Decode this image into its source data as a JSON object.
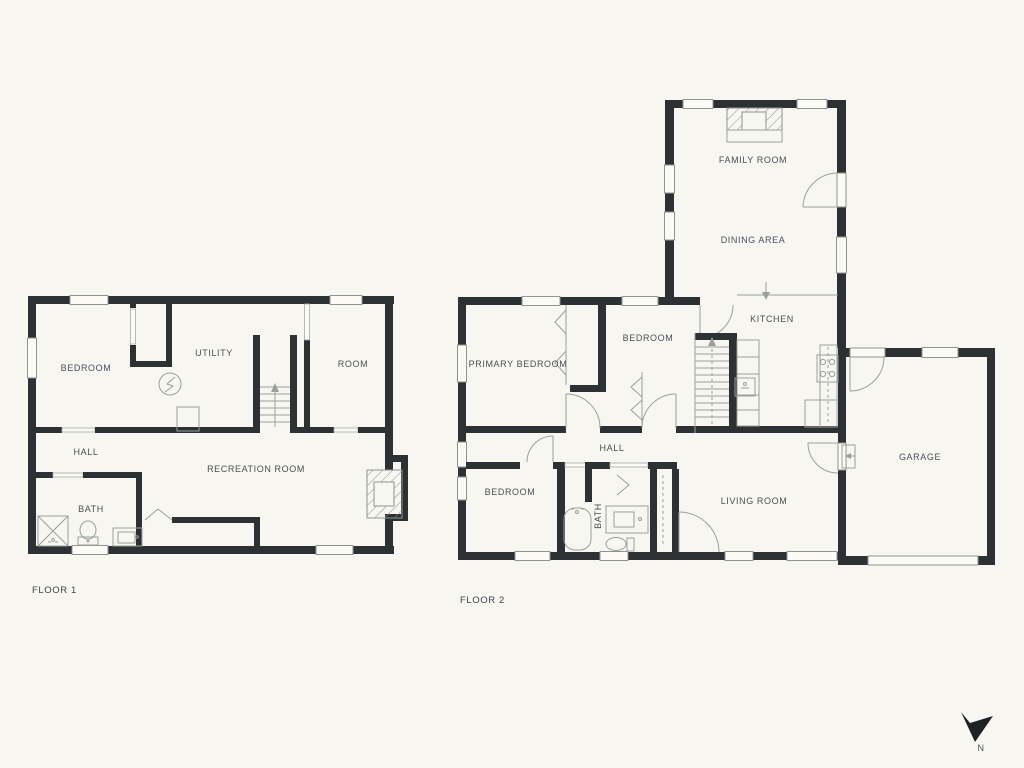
{
  "page": {
    "background_color": "#f7f6f1",
    "wall_color": "#2d3133",
    "thin_line_color": "#9aa09c",
    "text_color": "#4b5055"
  },
  "floor1": {
    "title": "FLOOR 1",
    "rooms": [
      {
        "label": "BEDROOM"
      },
      {
        "label": "UTILITY"
      },
      {
        "label": "ROOM"
      },
      {
        "label": "HALL"
      },
      {
        "label": "RECREATION ROOM"
      },
      {
        "label": "BATH"
      }
    ]
  },
  "floor2": {
    "title": "FLOOR 2",
    "rooms": [
      {
        "label": "FAMILY ROOM"
      },
      {
        "label": "DINING AREA"
      },
      {
        "label": "KITCHEN"
      },
      {
        "label": "PRIMARY BEDROOM"
      },
      {
        "label": "BEDROOM"
      },
      {
        "label": "HALL"
      },
      {
        "label": "BEDROOM"
      },
      {
        "label": "BATH"
      },
      {
        "label": "LIVING ROOM"
      },
      {
        "label": "GARAGE"
      }
    ]
  },
  "compass": {
    "label": "N"
  }
}
